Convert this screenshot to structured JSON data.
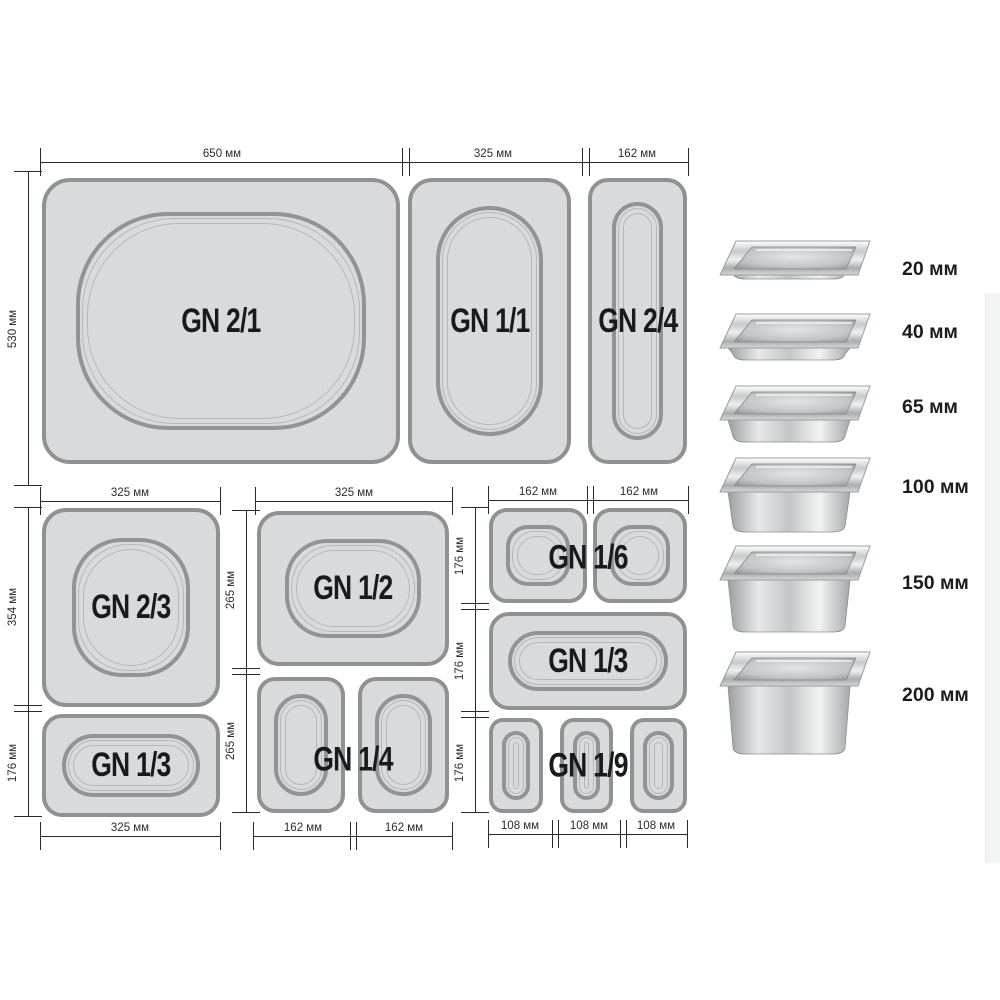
{
  "dims": {
    "top": {
      "w1": "650 мм",
      "w2": "325 мм",
      "w3": "162 мм",
      "h": "530 мм"
    },
    "ga": {
      "top": "325 мм",
      "h1": "354 мм",
      "h2": "176 мм",
      "bot": "325 мм"
    },
    "gb": {
      "top": "325 мм",
      "h1": "265 мм",
      "h2": "265 мм",
      "b1": "162 мм",
      "b2": "162 мм"
    },
    "gc": {
      "t1": "162 мм",
      "t2": "162 мм",
      "h1": "176 мм",
      "h2": "176 мм",
      "h3": "176 мм",
      "b1": "108 мм",
      "b2": "108 мм",
      "b3": "108 мм"
    }
  },
  "pans": {
    "gn21": "GN 2/1",
    "gn11": "GN 1/1",
    "gn24": "GN 2/4",
    "gn23": "GN 2/3",
    "gn13a": "GN 1/3",
    "gn12": "GN 1/2",
    "gn14": "GN 1/4",
    "gn16": "GN 1/6",
    "gn13c": "GN 1/3",
    "gn19": "GN 1/9"
  },
  "photo_column": {
    "items": [
      {
        "label": "20 мм"
      },
      {
        "label": "40 мм"
      },
      {
        "label": "65 мм"
      },
      {
        "label": "100 мм"
      },
      {
        "label": "150 мм"
      },
      {
        "label": "200 мм"
      }
    ]
  }
}
